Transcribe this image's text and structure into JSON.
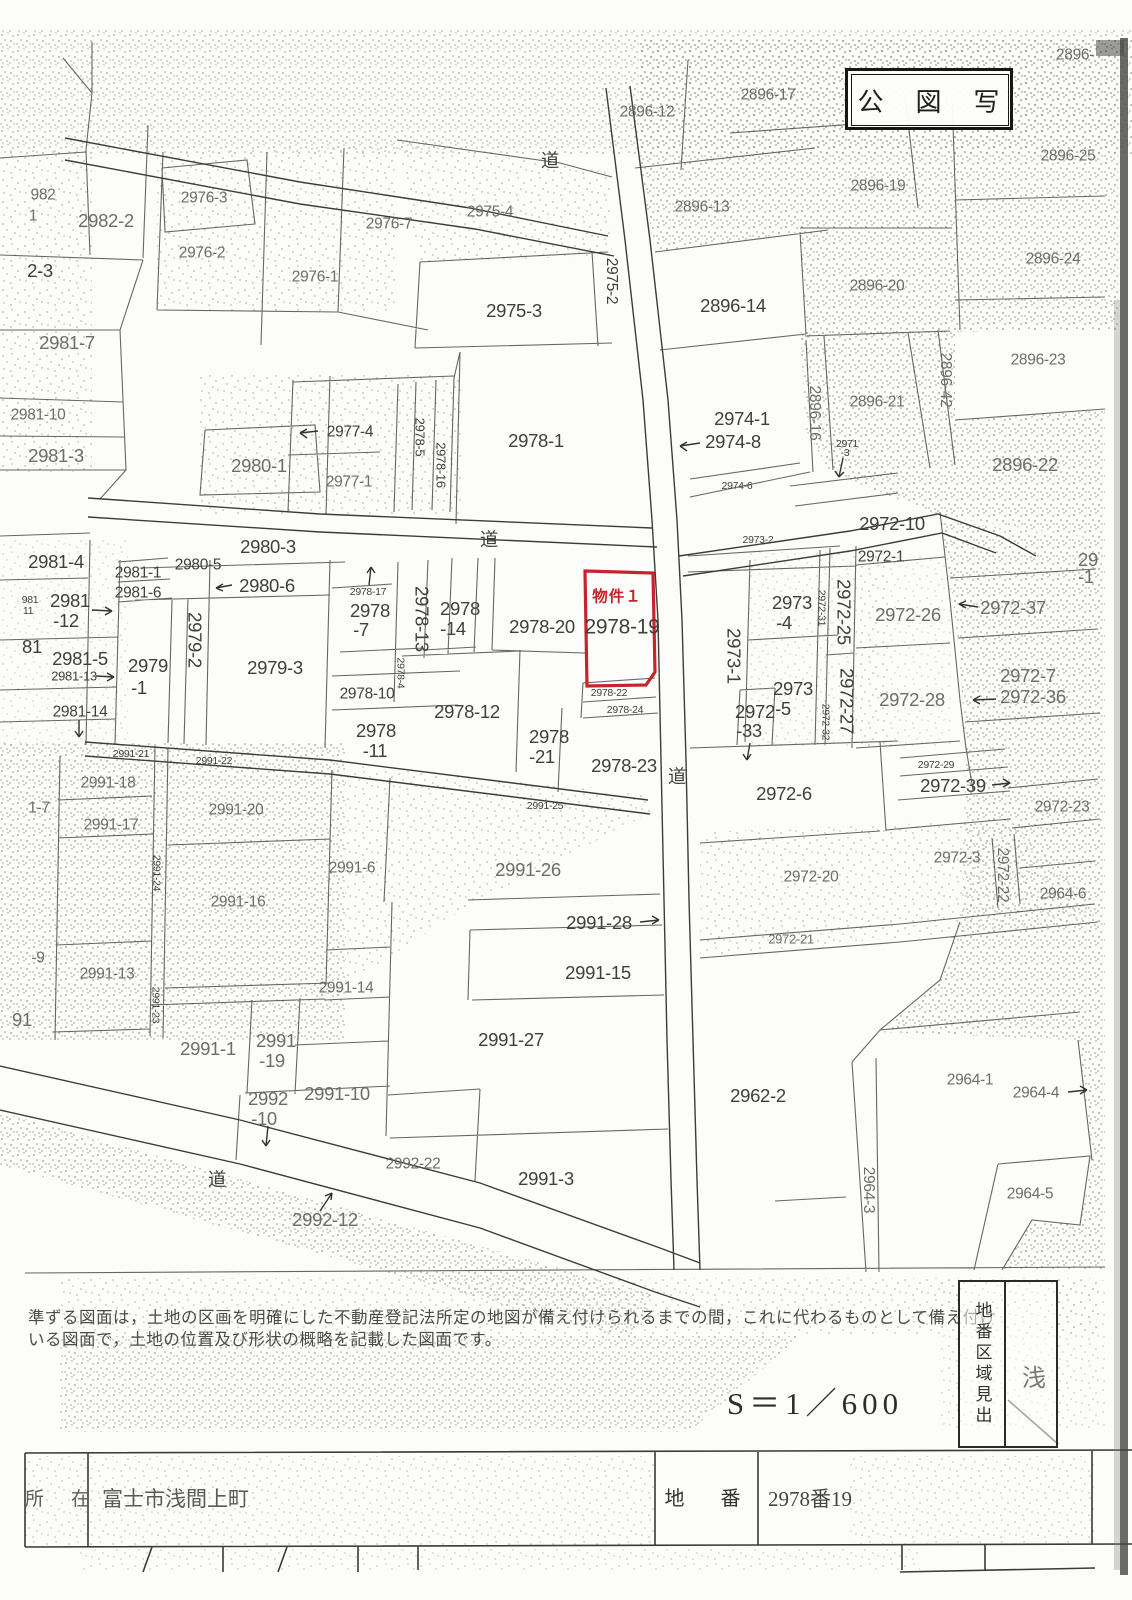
{
  "document": {
    "title": "公　図　写",
    "scale": "S＝1／600",
    "note_line1": "準ずる図面は，土地の区画を明確にした不動産登記法所定の地図が備え付けられるまでの間，これに代わるものとして備え付け",
    "note_line2": "いる図面で，土地の位置及び形状の概略を記載した図面です。",
    "side_tab": "地番区域見出",
    "side_partial": "浅",
    "footer_table": {
      "location_label": "所　在",
      "location_value": "富士市浅間上町",
      "lot_label": "地　番",
      "lot_value": "2978番19"
    }
  },
  "highlight": {
    "label": "物件１",
    "parcel": "2978-19",
    "color": "#c5242c"
  },
  "road_label": "道",
  "labels": [
    {
      "t": "2896-",
      "x": 1075,
      "y": 55,
      "s": "m",
      "c": "lt"
    },
    {
      "t": "2896-17",
      "x": 768,
      "y": 95,
      "s": "m",
      "c": "lt"
    },
    {
      "t": "2896-12",
      "x": 647,
      "y": 112,
      "s": "m",
      "c": "lt"
    },
    {
      "t": "2896-25",
      "x": 1068,
      "y": 156,
      "s": "m",
      "c": "lt"
    },
    {
      "t": "道",
      "x": 550,
      "y": 161,
      "s": "l"
    },
    {
      "t": "2896-19",
      "x": 878,
      "y": 186,
      "s": "m",
      "c": "lt"
    },
    {
      "t": "2896-13",
      "x": 702,
      "y": 207,
      "s": "m",
      "c": "lt"
    },
    {
      "t": "982",
      "x": 43,
      "y": 195,
      "s": "m",
      "c": "lt"
    },
    {
      "t": "1",
      "x": 33,
      "y": 216,
      "s": "m",
      "c": "lt"
    },
    {
      "t": "2982-2",
      "x": 106,
      "y": 221,
      "s": "l",
      "c": "lt"
    },
    {
      "t": "2976-3",
      "x": 204,
      "y": 198,
      "s": "m",
      "c": "lt"
    },
    {
      "t": "2976-7",
      "x": 389,
      "y": 224,
      "s": "m",
      "c": "lt"
    },
    {
      "t": "2-3",
      "x": 40,
      "y": 271,
      "s": "l"
    },
    {
      "t": "2976-2",
      "x": 202,
      "y": 253,
      "s": "m",
      "c": "lt"
    },
    {
      "t": "2975-4",
      "x": 490,
      "y": 212,
      "s": "m",
      "c": "lt"
    },
    {
      "t": "2896-24",
      "x": 1053,
      "y": 259,
      "s": "m",
      "c": "lt"
    },
    {
      "t": "2976-1",
      "x": 315,
      "y": 277,
      "s": "m",
      "c": "lt"
    },
    {
      "t": "2975-2",
      "x": 611,
      "y": 281,
      "s": "m",
      "r": 90
    },
    {
      "t": "2975-3",
      "x": 514,
      "y": 311,
      "s": "l"
    },
    {
      "t": "2896-14",
      "x": 733,
      "y": 306,
      "s": "l"
    },
    {
      "t": "2896-20",
      "x": 877,
      "y": 286,
      "s": "m",
      "c": "lt"
    },
    {
      "t": "2981-7",
      "x": 67,
      "y": 343,
      "s": "l",
      "c": "lt"
    },
    {
      "t": "2896-23",
      "x": 1038,
      "y": 360,
      "s": "m",
      "c": "lt"
    },
    {
      "t": "2896-42",
      "x": 945,
      "y": 380,
      "s": "m",
      "r": 90,
      "c": "lt"
    },
    {
      "t": "2896-21",
      "x": 877,
      "y": 402,
      "s": "m",
      "c": "lt"
    },
    {
      "t": "2981-10",
      "x": 38,
      "y": 415,
      "s": "m",
      "c": "lt"
    },
    {
      "t": "2981-3",
      "x": 56,
      "y": 456,
      "s": "l",
      "c": "lt"
    },
    {
      "t": "2978-5",
      "x": 420,
      "y": 437,
      "s": "s",
      "r": 90
    },
    {
      "t": "2978-16",
      "x": 441,
      "y": 465,
      "s": "s",
      "r": 90
    },
    {
      "t": "2977-4",
      "x": 350,
      "y": 432,
      "s": "m"
    },
    {
      "t": "2977-1",
      "x": 349,
      "y": 482,
      "s": "m",
      "c": "lt"
    },
    {
      "t": "2980-1",
      "x": 259,
      "y": 466,
      "s": "l",
      "c": "lt"
    },
    {
      "t": "2978-1",
      "x": 536,
      "y": 441,
      "s": "l"
    },
    {
      "t": "2974-1",
      "x": 742,
      "y": 419,
      "s": "l"
    },
    {
      "t": "2974-8",
      "x": 733,
      "y": 442,
      "s": "l"
    },
    {
      "t": "2896-16",
      "x": 814,
      "y": 413,
      "s": "m",
      "r": 90,
      "c": "lt"
    },
    {
      "t": "2971",
      "x": 847,
      "y": 444,
      "s": "xs"
    },
    {
      "t": "-3",
      "x": 845,
      "y": 453,
      "s": "xs"
    },
    {
      "t": "2896-22",
      "x": 1025,
      "y": 465,
      "s": "l",
      "c": "lt"
    },
    {
      "t": "2974-6",
      "x": 737,
      "y": 486,
      "s": "xs"
    },
    {
      "t": "2972-10",
      "x": 892,
      "y": 524,
      "s": "l"
    },
    {
      "t": "2980-3",
      "x": 268,
      "y": 547,
      "s": "l"
    },
    {
      "t": "道",
      "x": 489,
      "y": 540,
      "s": "l"
    },
    {
      "t": "2973-2",
      "x": 758,
      "y": 540,
      "s": "xs"
    },
    {
      "t": "2972-1",
      "x": 881,
      "y": 557,
      "s": "m"
    },
    {
      "t": "2981-4",
      "x": 56,
      "y": 562,
      "s": "l"
    },
    {
      "t": "2980-5",
      "x": 198,
      "y": 565,
      "s": "m"
    },
    {
      "t": "2981-1",
      "x": 138,
      "y": 573,
      "s": "m"
    },
    {
      "t": "2980-6",
      "x": 267,
      "y": 586,
      "s": "l"
    },
    {
      "t": "2981-6",
      "x": 138,
      "y": 593,
      "s": "m"
    },
    {
      "t": "2978-17",
      "x": 368,
      "y": 592,
      "s": "xs"
    },
    {
      "t": "2972-37",
      "x": 1013,
      "y": 608,
      "s": "l",
      "c": "lt"
    },
    {
      "t": "物件１",
      "x": 617,
      "y": 597,
      "s": "m",
      "c": "red"
    },
    {
      "t": "2978-19",
      "x": 622,
      "y": 627,
      "s": "xl"
    },
    {
      "t": "2978-20",
      "x": 542,
      "y": 627,
      "s": "l"
    },
    {
      "t": "2978",
      "x": 370,
      "y": 611,
      "s": "l"
    },
    {
      "t": "-7",
      "x": 361,
      "y": 630,
      "s": "l"
    },
    {
      "t": "2978-13",
      "x": 421,
      "y": 619,
      "s": "l",
      "r": 90
    },
    {
      "t": "2978",
      "x": 460,
      "y": 609,
      "s": "l"
    },
    {
      "t": "-14",
      "x": 453,
      "y": 629,
      "s": "l"
    },
    {
      "t": "2973",
      "x": 792,
      "y": 603,
      "s": "l"
    },
    {
      "t": "-4",
      "x": 784,
      "y": 623,
      "s": "l"
    },
    {
      "t": "2973-1",
      "x": 733,
      "y": 656,
      "s": "l",
      "r": 90
    },
    {
      "t": "2972-31",
      "x": 821,
      "y": 608,
      "s": "xs",
      "r": 90
    },
    {
      "t": "2972-25",
      "x": 843,
      "y": 612,
      "s": "l",
      "r": 90
    },
    {
      "t": "2972-26",
      "x": 908,
      "y": 615,
      "s": "l",
      "c": "lt"
    },
    {
      "t": "2979-2",
      "x": 194,
      "y": 640,
      "s": "l",
      "r": 90
    },
    {
      "t": "2979",
      "x": 148,
      "y": 666,
      "s": "l"
    },
    {
      "t": "-1",
      "x": 139,
      "y": 688,
      "s": "l"
    },
    {
      "t": "2979-3",
      "x": 275,
      "y": 668,
      "s": "l"
    },
    {
      "t": "981",
      "x": 30,
      "y": 600,
      "s": "xs"
    },
    {
      "t": "11",
      "x": 28,
      "y": 611,
      "s": "xs"
    },
    {
      "t": "2981",
      "x": 70,
      "y": 601,
      "s": "l"
    },
    {
      "t": "-12",
      "x": 66,
      "y": 621,
      "s": "l"
    },
    {
      "t": "81",
      "x": 32,
      "y": 647,
      "s": "l"
    },
    {
      "t": "2981-5",
      "x": 80,
      "y": 659,
      "s": "l"
    },
    {
      "t": "2981-13",
      "x": 74,
      "y": 676,
      "s": "s"
    },
    {
      "t": "2978-10",
      "x": 367,
      "y": 694,
      "s": "m"
    },
    {
      "t": "2978-4",
      "x": 400,
      "y": 673,
      "s": "xs",
      "r": 90
    },
    {
      "t": "2981-14",
      "x": 80,
      "y": 712,
      "s": "m"
    },
    {
      "t": "2978-12",
      "x": 467,
      "y": 712,
      "s": "l"
    },
    {
      "t": "2978-22",
      "x": 609,
      "y": 693,
      "s": "xs"
    },
    {
      "t": "2978-24",
      "x": 625,
      "y": 710,
      "s": "xs"
    },
    {
      "t": "2978",
      "x": 376,
      "y": 731,
      "s": "l"
    },
    {
      "t": "-11",
      "x": 375,
      "y": 751,
      "s": "l"
    },
    {
      "t": "2972",
      "x": 755,
      "y": 712,
      "s": "l"
    },
    {
      "t": "-33",
      "x": 749,
      "y": 731,
      "s": "l"
    },
    {
      "t": "2973",
      "x": 793,
      "y": 689,
      "s": "l"
    },
    {
      "t": "-5",
      "x": 783,
      "y": 709,
      "s": "l"
    },
    {
      "t": "2972-32",
      "x": 825,
      "y": 722,
      "s": "xs",
      "r": 90
    },
    {
      "t": "2972-27",
      "x": 846,
      "y": 701,
      "s": "l",
      "r": 90
    },
    {
      "t": "2972-28",
      "x": 912,
      "y": 700,
      "s": "l",
      "c": "lt"
    },
    {
      "t": "2972-7",
      "x": 1028,
      "y": 676,
      "s": "l",
      "c": "lt"
    },
    {
      "t": "2972-36",
      "x": 1033,
      "y": 697,
      "s": "l",
      "c": "lt"
    },
    {
      "t": "2978",
      "x": 549,
      "y": 737,
      "s": "l"
    },
    {
      "t": "-21",
      "x": 542,
      "y": 757,
      "s": "l"
    },
    {
      "t": "2978-23",
      "x": 624,
      "y": 766,
      "s": "l"
    },
    {
      "t": "道",
      "x": 677,
      "y": 777,
      "s": "l"
    },
    {
      "t": "2972-29",
      "x": 936,
      "y": 765,
      "s": "xs"
    },
    {
      "t": "2972-39",
      "x": 953,
      "y": 786,
      "s": "l"
    },
    {
      "t": "2972-6",
      "x": 784,
      "y": 794,
      "s": "l"
    },
    {
      "t": "29",
      "x": 1088,
      "y": 560,
      "s": "l",
      "c": "lt"
    },
    {
      "t": "-1",
      "x": 1086,
      "y": 577,
      "s": "l",
      "c": "lt"
    },
    {
      "t": "2991-21",
      "x": 131,
      "y": 754,
      "s": "xs"
    },
    {
      "t": "2991-22",
      "x": 214,
      "y": 761,
      "s": "xs"
    },
    {
      "t": "2991-18",
      "x": 108,
      "y": 783,
      "s": "m",
      "c": "lt"
    },
    {
      "t": "1-7",
      "x": 39,
      "y": 808,
      "s": "m",
      "c": "lt"
    },
    {
      "t": "2991-17",
      "x": 111,
      "y": 825,
      "s": "m",
      "c": "lt"
    },
    {
      "t": "2991-20",
      "x": 236,
      "y": 810,
      "s": "m",
      "c": "lt"
    },
    {
      "t": "2972-23",
      "x": 1062,
      "y": 807,
      "s": "m",
      "c": "lt"
    },
    {
      "t": "2972-3",
      "x": 957,
      "y": 858,
      "s": "m",
      "c": "lt"
    },
    {
      "t": "2972-20",
      "x": 811,
      "y": 877,
      "s": "m",
      "c": "lt"
    },
    {
      "t": "2991-25",
      "x": 545,
      "y": 806,
      "s": "xs"
    },
    {
      "t": "2991-26",
      "x": 528,
      "y": 870,
      "s": "l",
      "c": "lt"
    },
    {
      "t": "2991-24",
      "x": 156,
      "y": 873,
      "s": "xs",
      "r": 90
    },
    {
      "t": "2991-16",
      "x": 238,
      "y": 902,
      "s": "m",
      "c": "lt"
    },
    {
      "t": "2991-6",
      "x": 352,
      "y": 868,
      "s": "m",
      "c": "lt"
    },
    {
      "t": "2972-22",
      "x": 1002,
      "y": 875,
      "s": "m",
      "r": 90,
      "c": "lt"
    },
    {
      "t": "2964-6",
      "x": 1063,
      "y": 894,
      "s": "m",
      "c": "lt"
    },
    {
      "t": "2991-28",
      "x": 599,
      "y": 923,
      "s": "l"
    },
    {
      "t": "2972-21",
      "x": 791,
      "y": 939,
      "s": "s",
      "c": "lt"
    },
    {
      "t": "2991-13",
      "x": 107,
      "y": 974,
      "s": "m",
      "c": "lt"
    },
    {
      "t": "2991-15",
      "x": 598,
      "y": 973,
      "s": "l"
    },
    {
      "t": "2991-23",
      "x": 155,
      "y": 1005,
      "s": "xs",
      "r": 90
    },
    {
      "t": "2991-14",
      "x": 346,
      "y": 988,
      "s": "m",
      "c": "lt"
    },
    {
      "t": "-9",
      "x": 38,
      "y": 958,
      "s": "m",
      "c": "lt"
    },
    {
      "t": "2991-27",
      "x": 511,
      "y": 1040,
      "s": "l"
    },
    {
      "t": "91",
      "x": 22,
      "y": 1020,
      "s": "l",
      "c": "lt"
    },
    {
      "t": "2991-1",
      "x": 208,
      "y": 1049,
      "s": "l",
      "c": "lt"
    },
    {
      "t": "2991",
      "x": 276,
      "y": 1041,
      "s": "l",
      "c": "lt"
    },
    {
      "t": "-19",
      "x": 272,
      "y": 1061,
      "s": "l",
      "c": "lt"
    },
    {
      "t": "2992",
      "x": 268,
      "y": 1099,
      "s": "l",
      "c": "lt"
    },
    {
      "t": "-10",
      "x": 264,
      "y": 1119,
      "s": "l",
      "c": "lt"
    },
    {
      "t": "2991-10",
      "x": 337,
      "y": 1094,
      "s": "l",
      "c": "lt"
    },
    {
      "t": "2962-2",
      "x": 758,
      "y": 1096,
      "s": "l"
    },
    {
      "t": "2964-1",
      "x": 970,
      "y": 1080,
      "s": "m",
      "c": "lt"
    },
    {
      "t": "2964-4",
      "x": 1036,
      "y": 1093,
      "s": "m",
      "c": "lt"
    },
    {
      "t": "2992-22",
      "x": 413,
      "y": 1164,
      "s": "m",
      "c": "lt"
    },
    {
      "t": "2964-3",
      "x": 868,
      "y": 1190,
      "s": "m",
      "r": 90,
      "c": "lt"
    },
    {
      "t": "道",
      "x": 217,
      "y": 1180,
      "s": "l"
    },
    {
      "t": "2991-3",
      "x": 546,
      "y": 1179,
      "s": "l"
    },
    {
      "t": "2964-5",
      "x": 1030,
      "y": 1194,
      "s": "m",
      "c": "lt"
    },
    {
      "t": "2992-12",
      "x": 325,
      "y": 1220,
      "s": "l",
      "c": "lt"
    }
  ]
}
